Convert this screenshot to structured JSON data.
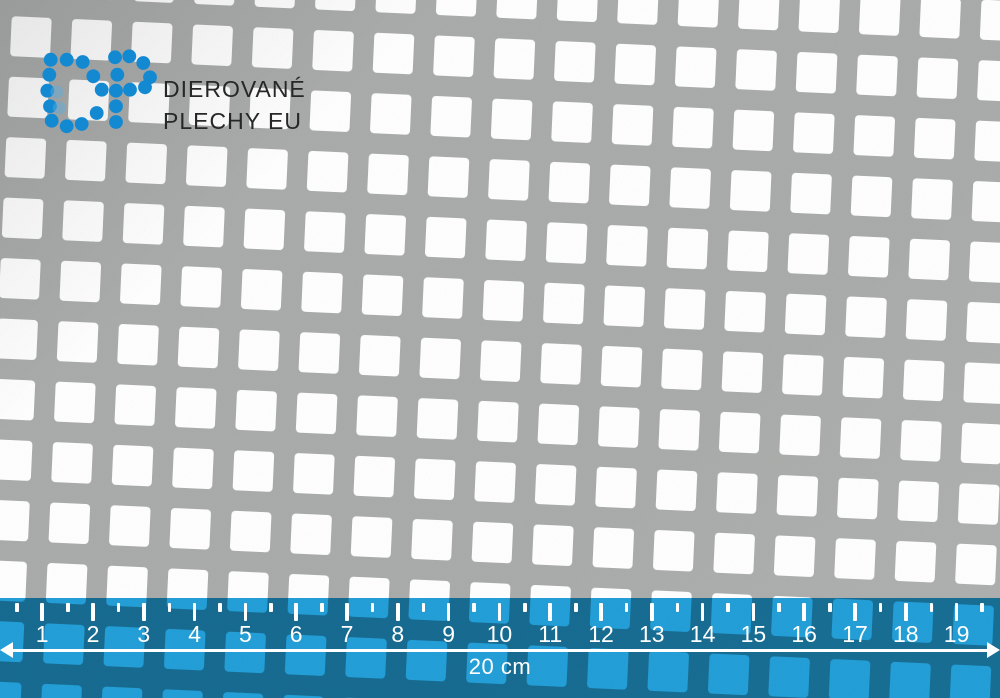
{
  "brand": {
    "monogram": "DP",
    "line1": "DIEROVANÉ",
    "line2": "PLECHY EU",
    "logo_color": "#1389d2",
    "text_color": "#272727"
  },
  "sheet": {
    "hole_shape": "square",
    "metal_color": "#a8aaa9",
    "hole_color": "#ffffff"
  },
  "ruler": {
    "labels": [
      "1",
      "2",
      "3",
      "4",
      "5",
      "6",
      "7",
      "8",
      "9",
      "10",
      "11",
      "12",
      "13",
      "14",
      "15",
      "16",
      "17",
      "18",
      "19"
    ],
    "total_label": "20 cm",
    "overlay_color": "#239fd8",
    "tick_color": "#ffffff"
  }
}
